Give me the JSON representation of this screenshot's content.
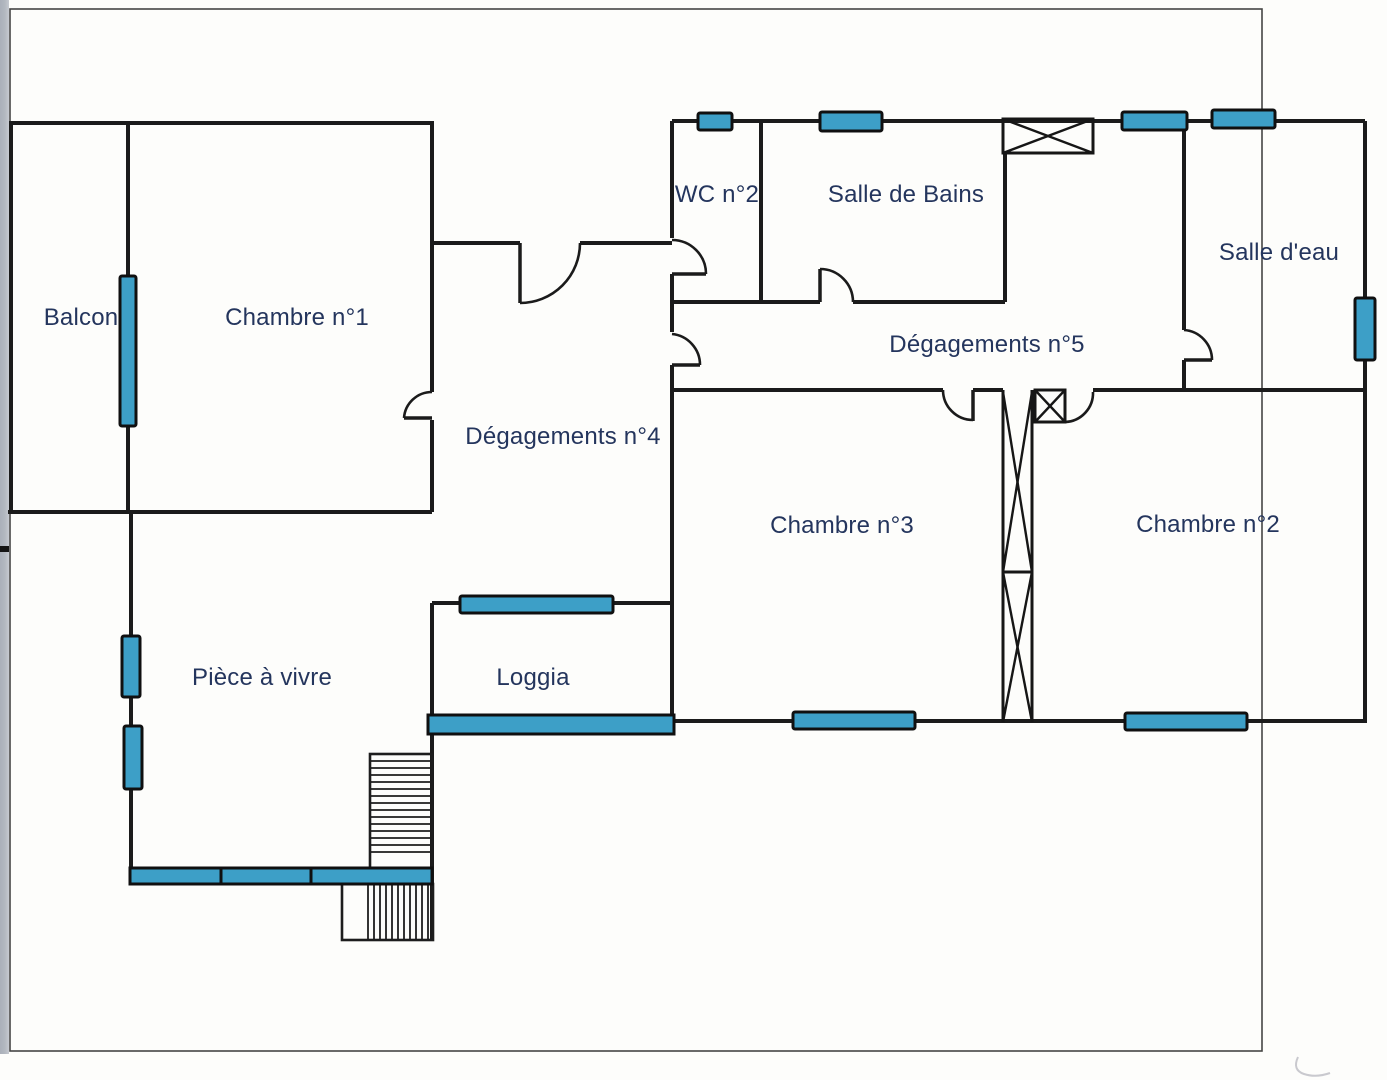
{
  "rooms": [
    {
      "id": "balcon",
      "label": "Balcon"
    },
    {
      "id": "chambre1",
      "label": "Chambre n°1"
    },
    {
      "id": "wc2",
      "label": "WC n°2"
    },
    {
      "id": "salle_de_bains",
      "label": "Salle de Bains"
    },
    {
      "id": "salle_deau",
      "label": "Salle d'eau"
    },
    {
      "id": "degagements5",
      "label": "Dégagements n°5"
    },
    {
      "id": "degagements4",
      "label": "Dégagements n°4"
    },
    {
      "id": "chambre3",
      "label": "Chambre n°3"
    },
    {
      "id": "chambre2",
      "label": "Chambre n°2"
    },
    {
      "id": "piece_a_vivre",
      "label": "Pièce à vivre"
    },
    {
      "id": "loggia",
      "label": "Loggia"
    }
  ],
  "colors": {
    "wall": "#1b1b1b",
    "window_fill": "#3d9fc7",
    "label_text": "#24355d",
    "page_border": "#454545",
    "scanner_strip": "#b3b8c0",
    "background": "#fdfdfb"
  }
}
